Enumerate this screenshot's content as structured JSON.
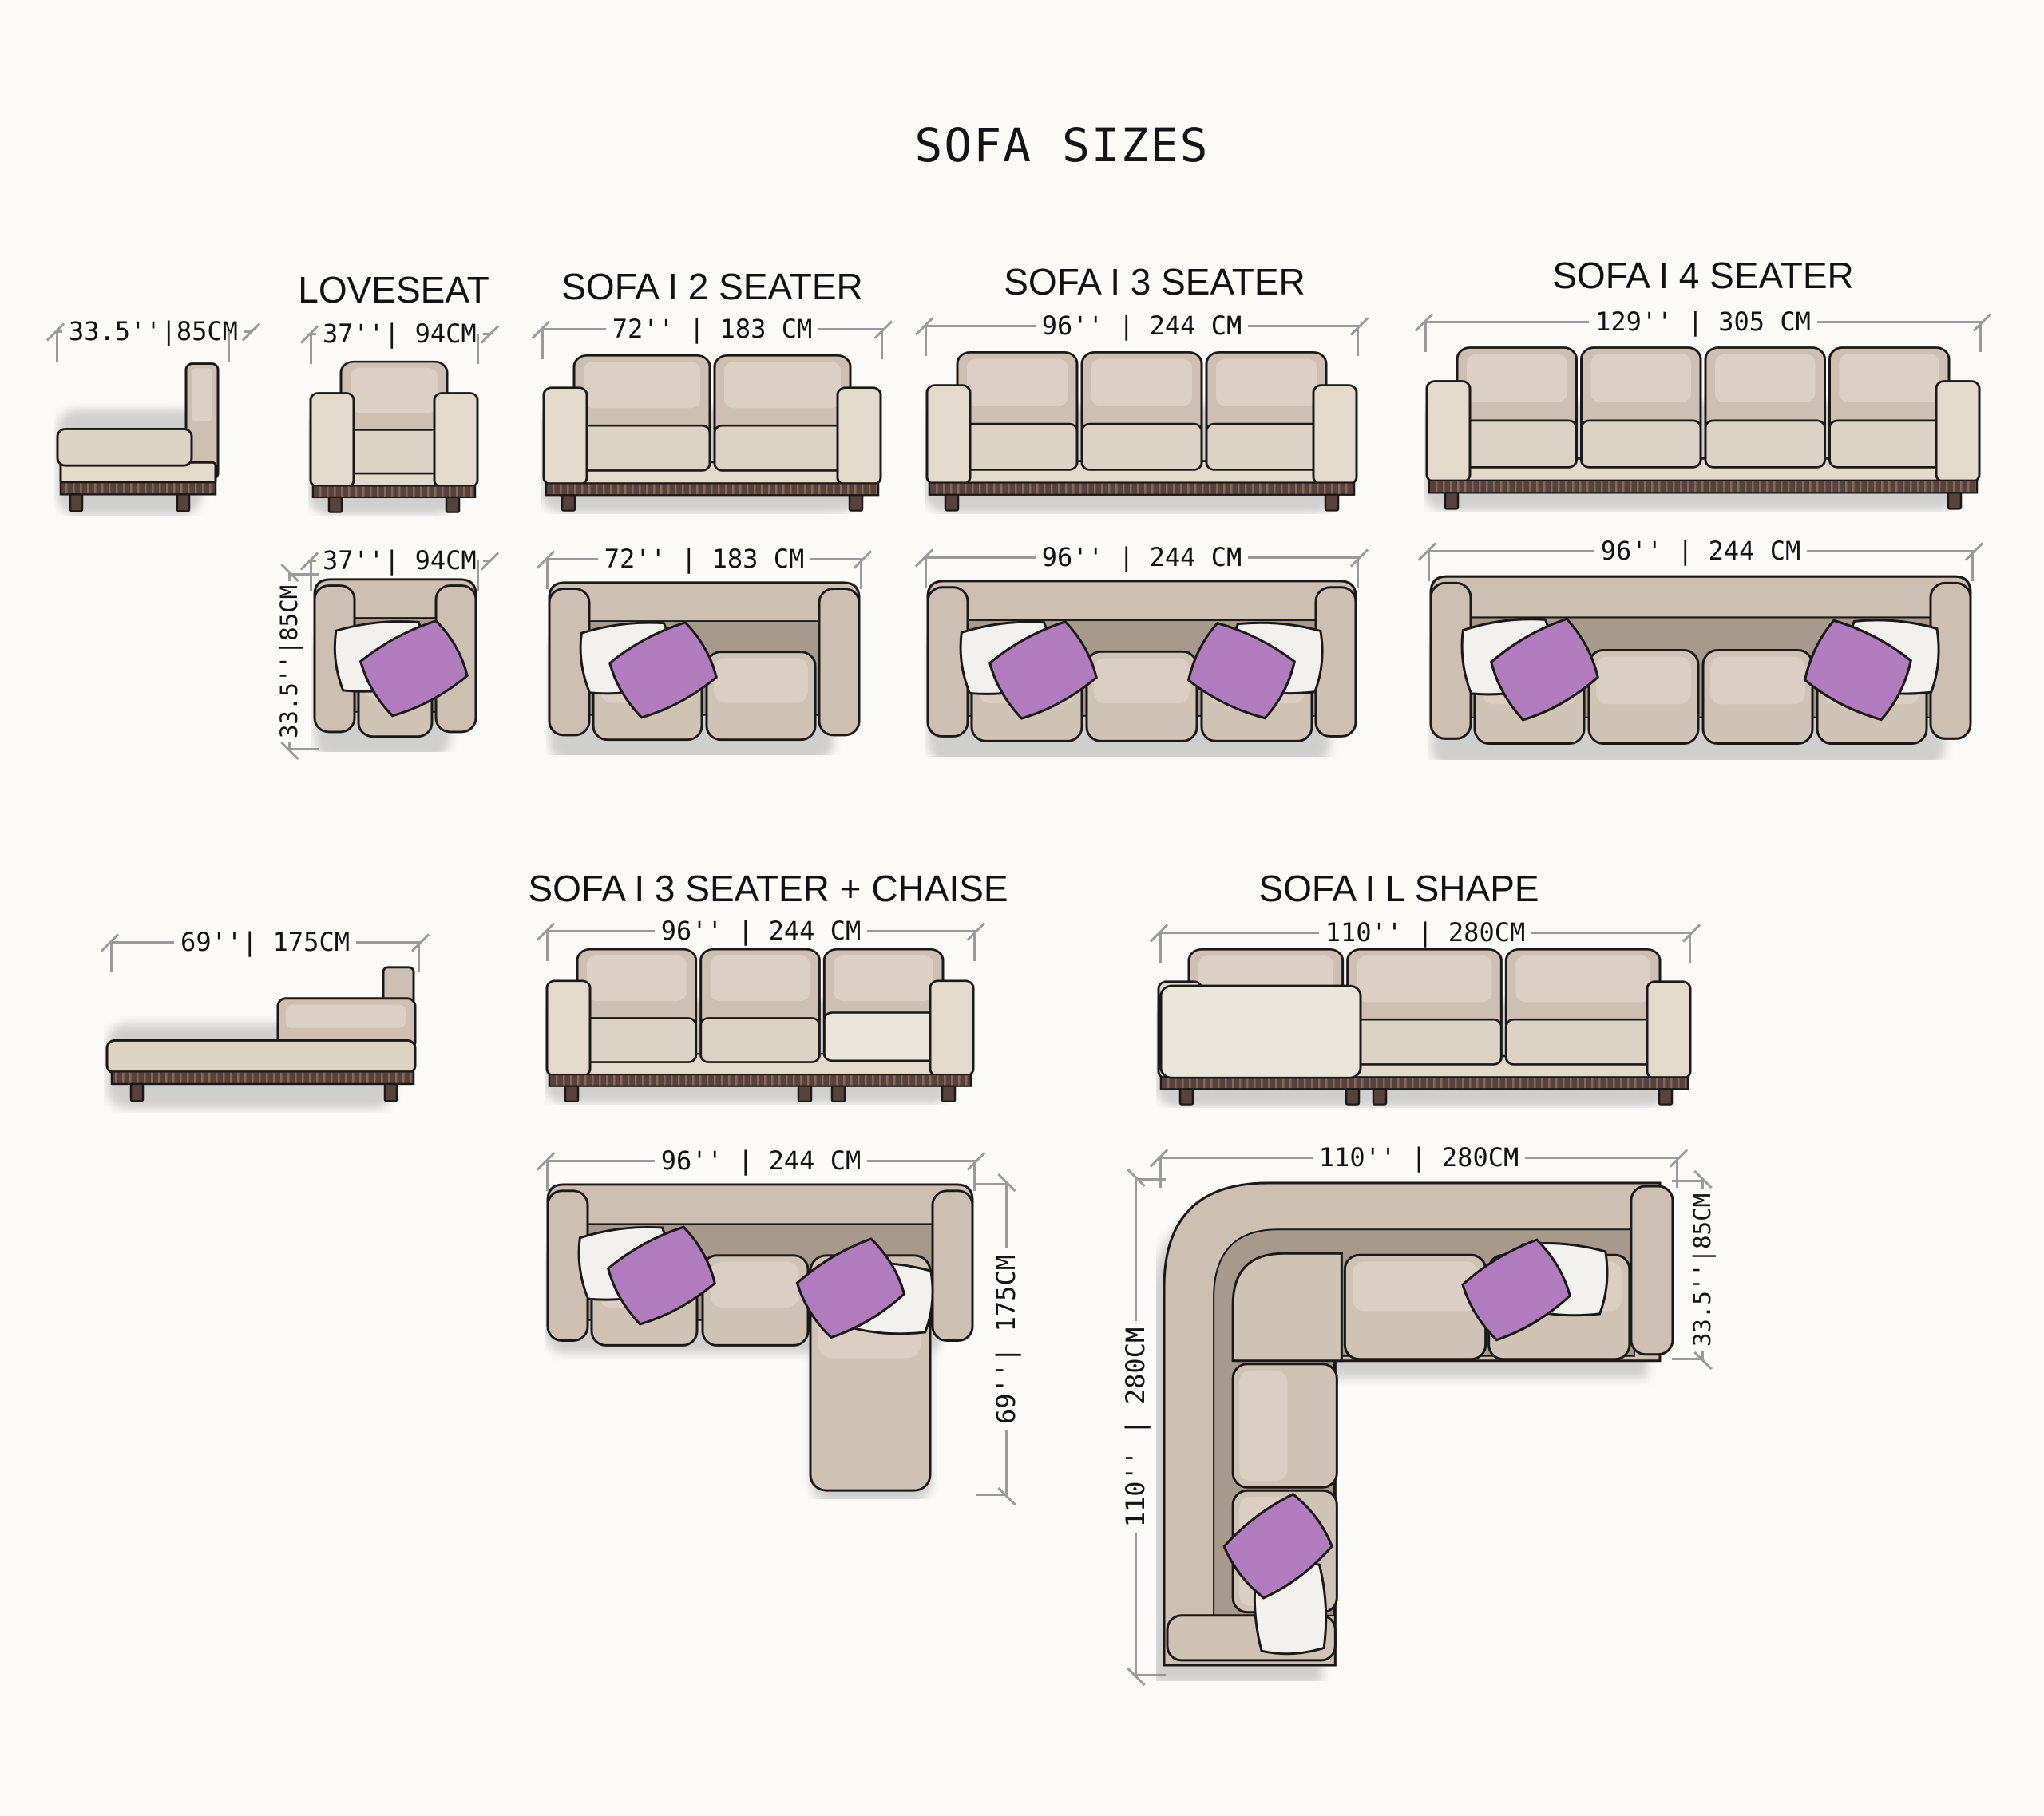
{
  "title": "SOFA SIZES",
  "sofas": {
    "side_view": {
      "depth_dim": "33.5''|85CM"
    },
    "loveseat": {
      "label": "LOVESEAT",
      "width_dim": "37''| 94CM",
      "top_width_dim": "37''| 94CM",
      "depth_dim": "33.5''|85CM"
    },
    "two_seater": {
      "label": "SOFA I 2 SEATER",
      "width_dim": "72'' | 183 CM",
      "top_width_dim": "72'' | 183 CM"
    },
    "three_seater": {
      "label": "SOFA I 3 SEATER",
      "width_dim": "96'' | 244 CM",
      "top_width_dim": "96'' | 244 CM"
    },
    "four_seater": {
      "label": "SOFA I 4 SEATER",
      "width_dim": "129'' | 305 CM",
      "top_width_dim": "96'' | 244 CM"
    },
    "chaise_side_view": {
      "length_dim": "69''| 175CM"
    },
    "three_seater_chaise": {
      "label": "SOFA I 3 SEATER + CHAISE",
      "width_dim": "96'' | 244 CM",
      "top_width_dim": "96'' | 244 CM",
      "depth_dim": "69''| 175CM"
    },
    "l_shape": {
      "label": "SOFA I L SHAPE",
      "width_dim": "110'' | 280CM",
      "top_width_dim": "110'' | 280CM",
      "left_height_dim": "110'' | 280CM",
      "depth_dim": "33.5''|85CM"
    }
  },
  "colors": {
    "line": "#1b1917",
    "back": "#cdc0b2",
    "backHi": "#dbd0c3",
    "seat": "#ddd3c5",
    "arm": "#e4dacc",
    "seatTop": "#cfc3b5",
    "seatTopHi": "#dacfc2",
    "innerDark": "#a79a8d",
    "chaise": "#ebe6db",
    "fringe": "#57433b",
    "fringeStripe": "#86685c",
    "purple": "#b17cbd",
    "pillow": "#f2f1ee",
    "dimLine": "#9a9a9a",
    "shadow": "#8a8a8a"
  }
}
